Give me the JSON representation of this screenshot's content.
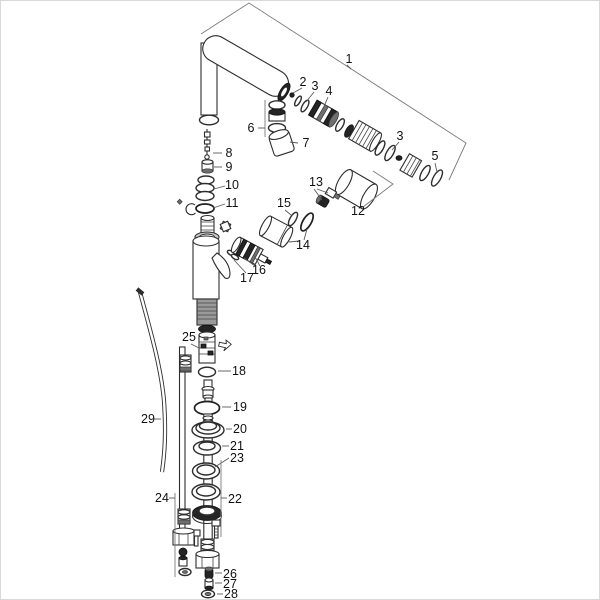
{
  "diagram": {
    "background_color": "#ffffff",
    "line_color": "#2d2d2d",
    "leader_line_color": "#5a5a5a",
    "label_color": "#111111",
    "labels": {
      "p1": "1",
      "p2": "2",
      "p3a": "3",
      "p4": "4",
      "p3b": "3",
      "p5": "5",
      "p6": "6",
      "p7": "7",
      "p8": "8",
      "p9": "9",
      "p10": "10",
      "p11": "11",
      "p12": "12",
      "p13": "13",
      "p14": "14",
      "p15": "15",
      "p16": "16",
      "p17": "17",
      "p18": "18",
      "p19": "19",
      "p20": "20",
      "p21": "21",
      "p22": "22",
      "p23": "23",
      "p24": "24",
      "p25": "25",
      "p26": "26",
      "p27": "27",
      "p28": "28",
      "p29": "29"
    },
    "icons": {
      "flow_direction": "left-arrow-icon"
    }
  }
}
